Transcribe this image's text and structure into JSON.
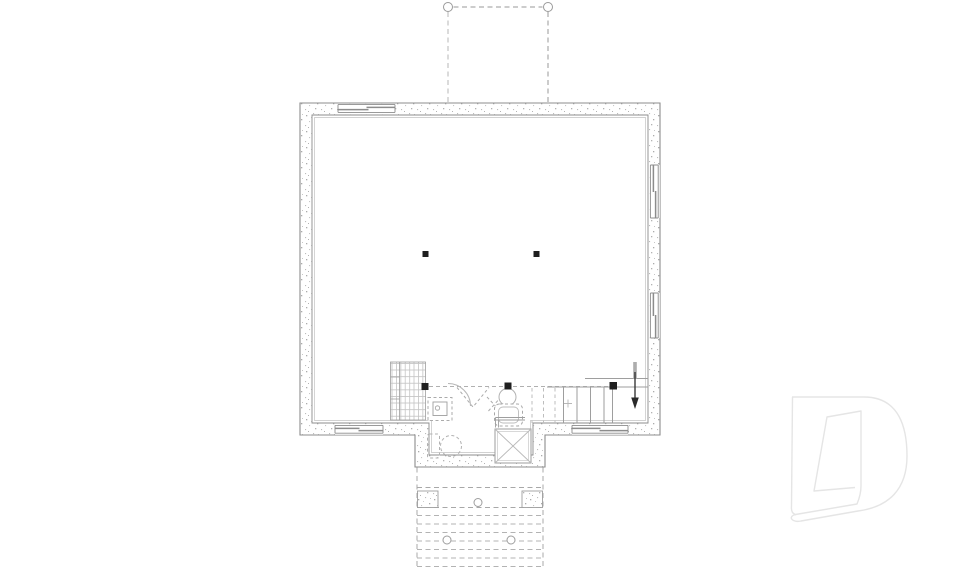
{
  "canvas": {
    "width": 960,
    "height": 569,
    "background": "#ffffff"
  },
  "plan": {
    "title": "Basement foundation floor plan drawing",
    "type": "floor-plan",
    "colors": {
      "wall_line": "#8c8c8c",
      "medium_line": "#9e9e9e",
      "light_line": "#b4b4b4",
      "dashed_line": "#a8a8a8",
      "post_black": "#1f1f1f",
      "watermark": "#e5e5e5",
      "background": "#ffffff"
    },
    "components": [
      "foundation-walls",
      "basement-windows",
      "deck-above-dashed",
      "structural-posts",
      "beam-line",
      "storage-shelving",
      "future-bathroom-fixtures",
      "water-heater",
      "landing-with-x",
      "staircase-up",
      "rear-landing-piers",
      "exterior-steps-dashed",
      "brand-watermark"
    ],
    "elements": [
      {
        "name": "foundation-wall-band",
        "type": "path",
        "attrs": {
          "d": "M300,103 H660 V435 H545 V467 H415 V435 H300 Z M312,115 H648 V423 H533 V455 H429 V423 H312 Z",
          "fill": "url(#stipple)",
          "fill-rule": "evenodd",
          "stroke": "none"
        }
      },
      {
        "name": "foundation-wall-outer-line",
        "type": "path",
        "attrs": {
          "d": "M300,103 H660 V435 H545 V467 H415 V435 H300 Z",
          "fill": "none",
          "stroke": "#8c8c8c",
          "stroke-width": "1.1"
        }
      },
      {
        "name": "foundation-wall-inner-line",
        "type": "path",
        "attrs": {
          "d": "M312,115 H648 V423 H533 V455 H429 V423 H312 Z",
          "fill": "none",
          "stroke": "#8c8c8c",
          "stroke-width": "0.9"
        }
      },
      {
        "name": "foundation-wall-furring-line",
        "type": "path",
        "attrs": {
          "d": "M314.5,117.5 H645.5 V420.5 H530.5 V452.5 H431.5 V420.5 H314.5 Z",
          "fill": "none",
          "stroke": "#c2c2c2",
          "stroke-width": "0.7"
        }
      },
      {
        "name": "window-top-opening",
        "type": "rect",
        "attrs": {
          "x": "338",
          "y": "103.6",
          "width": "57",
          "height": "10.8",
          "fill": "#ffffff"
        }
      },
      {
        "name": "window-top-frame",
        "type": "path",
        "attrs": {
          "d": "M338,104.6 H395 M338,112.4 H395 M338,104.6 V112.4 M395,104.6 V112.4",
          "fill": "none",
          "stroke": "#8c8c8c",
          "stroke-width": "0.9"
        }
      },
      {
        "name": "window-top-sash",
        "type": "path",
        "attrs": {
          "d": "M338,109.6 H368.5 M366.5,107.4 H395",
          "fill": "none",
          "stroke": "#8c8c8c",
          "stroke-width": "1.5"
        }
      },
      {
        "name": "window-bottom-left-opening",
        "type": "rect",
        "attrs": {
          "x": "335",
          "y": "424.2",
          "width": "48",
          "height": "10.6",
          "fill": "#ffffff"
        }
      },
      {
        "name": "window-bottom-left-frame",
        "type": "path",
        "attrs": {
          "d": "M335,425.4 H383 M335,433.2 H383 M335,425.4 V433.2 M383,425.4 V433.2",
          "fill": "none",
          "stroke": "#8c8c8c",
          "stroke-width": "0.9"
        }
      },
      {
        "name": "window-bottom-left-sash",
        "type": "path",
        "attrs": {
          "d": "M335,428.4 H359.5 M358.5,430.6 H383",
          "fill": "none",
          "stroke": "#8c8c8c",
          "stroke-width": "1.5"
        }
      },
      {
        "name": "window-bottom-right-opening",
        "type": "rect",
        "attrs": {
          "x": "572",
          "y": "424.2",
          "width": "56",
          "height": "10.6",
          "fill": "#ffffff"
        }
      },
      {
        "name": "window-bottom-right-frame",
        "type": "path",
        "attrs": {
          "d": "M572,425.4 H628 M572,433.2 H628 M572,425.4 V433.2 M628,425.4 V433.2",
          "fill": "none",
          "stroke": "#8c8c8c",
          "stroke-width": "0.9"
        }
      },
      {
        "name": "window-bottom-right-sash",
        "type": "path",
        "attrs": {
          "d": "M572,428.4 H600.5 M599.5,430.6 H628",
          "fill": "none",
          "stroke": "#8c8c8c",
          "stroke-width": "1.5"
        }
      },
      {
        "name": "window-right-upper-opening",
        "type": "rect",
        "attrs": {
          "x": "649.2",
          "y": "165",
          "width": "10.6",
          "height": "53",
          "fill": "#ffffff"
        }
      },
      {
        "name": "window-right-upper-frame",
        "type": "path",
        "attrs": {
          "d": "M650.4,165 V218 M658.2,165 V218 M650.4,165 H658.2 M650.4,218 H658.2",
          "fill": "none",
          "stroke": "#8c8c8c",
          "stroke-width": "0.9"
        }
      },
      {
        "name": "window-right-upper-sash",
        "type": "path",
        "attrs": {
          "d": "M653.4,165 V192 M655.6,191 V218",
          "fill": "none",
          "stroke": "#8c8c8c",
          "stroke-width": "1.5"
        }
      },
      {
        "name": "window-right-lower-opening",
        "type": "rect",
        "attrs": {
          "x": "649.2",
          "y": "293",
          "width": "10.6",
          "height": "45",
          "fill": "#ffffff"
        }
      },
      {
        "name": "window-right-lower-frame",
        "type": "path",
        "attrs": {
          "d": "M650.4,293 V338 M658.2,293 V338 M650.4,293 H658.2 M650.4,338 H658.2",
          "fill": "none",
          "stroke": "#8c8c8c",
          "stroke-width": "0.9"
        }
      },
      {
        "name": "window-right-lower-sash",
        "type": "path",
        "attrs": {
          "d": "M653.4,293 V316 M655.6,315 V338",
          "fill": "none",
          "stroke": "#8c8c8c",
          "stroke-width": "1.5"
        }
      },
      {
        "name": "deck-above-post-left",
        "type": "circle",
        "attrs": {
          "cx": "448",
          "cy": "7",
          "r": "4.5",
          "fill": "#ffffff",
          "stroke": "#9a9a9a",
          "stroke-width": "1"
        }
      },
      {
        "name": "deck-above-post-right",
        "type": "circle",
        "attrs": {
          "cx": "548",
          "cy": "7",
          "r": "4.5",
          "fill": "#ffffff",
          "stroke": "#9a9a9a",
          "stroke-width": "1"
        }
      },
      {
        "name": "deck-above-edge-top",
        "type": "line",
        "attrs": {
          "x1": "453.5",
          "y1": "7",
          "x2": "542.5",
          "y2": "7",
          "stroke": "#9a9a9a",
          "stroke-width": "1",
          "stroke-dasharray": "5 3.5"
        }
      },
      {
        "name": "deck-above-edge-left",
        "type": "line",
        "attrs": {
          "x1": "448",
          "y1": "12",
          "x2": "448",
          "y2": "102",
          "stroke": "#c3c3c3",
          "stroke-width": "1.2",
          "stroke-dasharray": "5 3.5"
        }
      },
      {
        "name": "deck-above-edge-right",
        "type": "line",
        "attrs": {
          "x1": "548",
          "y1": "12",
          "x2": "548",
          "y2": "102",
          "stroke": "#9a9a9a",
          "stroke-width": "1",
          "stroke-dasharray": "5 3.5"
        }
      },
      {
        "name": "beam-dashed-line",
        "type": "line",
        "attrs": {
          "x1": "429",
          "y1": "386.5",
          "x2": "610",
          "y2": "386.5",
          "stroke": "#b0b0b0",
          "stroke-width": "1",
          "stroke-dasharray": "4 3"
        }
      },
      {
        "name": "storage-shelving-hatch",
        "type": "rect",
        "attrs": {
          "x": "390.5",
          "y": "362",
          "width": "35",
          "height": "58",
          "fill": "url(#gridhatch)",
          "stroke": "#9e9e9e",
          "stroke-width": "0.8"
        }
      },
      {
        "name": "storage-shelving-divider",
        "type": "path",
        "attrs": {
          "d": "M399.5,362 V420 M390.5,377 H399.5 M390.5,399 H399.5",
          "fill": "none",
          "stroke": "#9e9e9e",
          "stroke-width": "0.8"
        }
      },
      {
        "name": "door-swing-arc",
        "type": "path",
        "attrs": {
          "d": "M448,383.5 A22.5,22.5 0 0 1 470.5,406",
          "fill": "none",
          "stroke": "#b8b8b8",
          "stroke-width": "1"
        }
      },
      {
        "name": "door-leaf-dashed-v",
        "type": "polyline",
        "attrs": {
          "points": "457,387.5 473,407 489,387.5",
          "fill": "none",
          "stroke": "#ababab",
          "stroke-width": "1",
          "stroke-dasharray": "3 2.5"
        }
      },
      {
        "name": "door-leaf-dashed-a",
        "type": "line",
        "attrs": {
          "x1": "487",
          "y1": "397",
          "x2": "501",
          "y2": "412",
          "stroke": "#ababab",
          "stroke-width": "1",
          "stroke-dasharray": "3 2.5"
        }
      },
      {
        "name": "door-leaf-dashed-b",
        "type": "line",
        "attrs": {
          "x1": "501.5",
          "y1": "396.5",
          "x2": "488",
          "y2": "411.5",
          "stroke": "#ababab",
          "stroke-width": "1",
          "stroke-dasharray": "3 2.5"
        }
      },
      {
        "name": "laundry-cabinet-outline",
        "type": "rect",
        "attrs": {
          "x": "428",
          "y": "397.5",
          "width": "24",
          "height": "23",
          "fill": "#ffffff",
          "stroke": "#ababab",
          "stroke-width": "1",
          "stroke-dasharray": "3 2.5"
        }
      },
      {
        "name": "laundry-sink-inner",
        "type": "rect",
        "attrs": {
          "x": "433",
          "y": "402",
          "width": "14",
          "height": "13.5",
          "fill": "none",
          "stroke": "#9e9e9e",
          "stroke-width": "0.9"
        }
      },
      {
        "name": "laundry-drain",
        "type": "circle",
        "attrs": {
          "cx": "437.5",
          "cy": "408",
          "r": "2.2",
          "fill": "none",
          "stroke": "#9e9e9e",
          "stroke-width": "0.8"
        }
      },
      {
        "name": "toilet-bowl",
        "type": "circle",
        "attrs": {
          "cx": "507.5",
          "cy": "397",
          "r": "8.5",
          "fill": "#ffffff",
          "stroke": "#b2b2b2",
          "stroke-width": "1"
        }
      },
      {
        "name": "toilet-tank",
        "type": "rect",
        "attrs": {
          "x": "494.5",
          "y": "404",
          "width": "28",
          "height": "22",
          "rx": "5",
          "fill": "#ffffff",
          "stroke": "#a8a8a8",
          "stroke-width": "1",
          "stroke-dasharray": "3 2.5"
        }
      },
      {
        "name": "toilet-tank-inner",
        "type": "rect",
        "attrs": {
          "x": "498.5",
          "y": "407",
          "width": "20",
          "height": "16",
          "rx": "4.5",
          "fill": "none",
          "stroke": "#bcbcbc",
          "stroke-width": "0.9"
        }
      },
      {
        "name": "partition-stub-wall",
        "type": "path",
        "attrs": {
          "d": "M495.5,417.5 H525 M495.5,420 H525 M495.5,417.5 V427.5 M498.5,420 V427.5",
          "fill": "none",
          "stroke": "#9e9e9e",
          "stroke-width": "0.9"
        }
      },
      {
        "name": "landing-box",
        "type": "rect",
        "attrs": {
          "x": "495",
          "y": "429",
          "width": "36",
          "height": "34",
          "fill": "#ffffff",
          "stroke": "#9e9e9e",
          "stroke-width": "1"
        }
      },
      {
        "name": "landing-box-inner",
        "type": "rect",
        "attrs": {
          "x": "497.5",
          "y": "431.5",
          "width": "31",
          "height": "29",
          "fill": "none",
          "stroke": "#cfcfcf",
          "stroke-width": "0.8"
        }
      },
      {
        "name": "landing-box-diagonal-1",
        "type": "line",
        "attrs": {
          "x1": "495",
          "y1": "429",
          "x2": "531",
          "y2": "463",
          "stroke": "#b8b8b8",
          "stroke-width": "0.9"
        }
      },
      {
        "name": "landing-box-diagonal-2",
        "type": "line",
        "attrs": {
          "x1": "531",
          "y1": "429",
          "x2": "495",
          "y2": "463",
          "stroke": "#b8b8b8",
          "stroke-width": "0.9"
        }
      },
      {
        "name": "water-heater-circle",
        "type": "circle",
        "attrs": {
          "cx": "451",
          "cy": "446",
          "r": "10.5",
          "fill": "none",
          "stroke": "#b2b2b2",
          "stroke-width": "1",
          "stroke-dasharray": "3 2.5"
        }
      },
      {
        "name": "equipment-rect",
        "type": "rect",
        "attrs": {
          "x": "427.5",
          "y": "434",
          "width": "12",
          "height": "24",
          "rx": "2",
          "fill": "none",
          "stroke": "#b2b2b2",
          "stroke-width": "1",
          "stroke-dasharray": "3 2.5"
        }
      },
      {
        "name": "stair-treads-dashed",
        "type": "path",
        "attrs": {
          "d": "M532,388 V423 M543.5,388 V423 M555,388 V423",
          "fill": "none",
          "stroke": "#bdbdbd",
          "stroke-width": "1",
          "stroke-dasharray": "3.5 3"
        }
      },
      {
        "name": "stair-treads",
        "type": "path",
        "attrs": {
          "d": "M563.5,387.5 V423 M577,387.5 V423 M590.5,387.5 V423 M604,387.5 V423",
          "fill": "none",
          "stroke": "#9e9e9e",
          "stroke-width": "1"
        }
      },
      {
        "name": "stair-right-stringer",
        "type": "line",
        "attrs": {
          "x1": "612.5",
          "y1": "387.5",
          "x2": "612.5",
          "y2": "423",
          "stroke": "#9e9e9e",
          "stroke-width": "1"
        }
      },
      {
        "name": "stair-guard-line-upper",
        "type": "line",
        "attrs": {
          "x1": "585",
          "y1": "378.5",
          "x2": "648",
          "y2": "378.5",
          "stroke": "#9e9e9e",
          "stroke-width": "1"
        }
      },
      {
        "name": "stair-guard-line-lower",
        "type": "line",
        "attrs": {
          "x1": "547",
          "y1": "387",
          "x2": "648",
          "y2": "387",
          "stroke": "#9e9e9e",
          "stroke-width": "1"
        }
      },
      {
        "name": "stair-arrow-tail",
        "type": "rect",
        "attrs": {
          "x": "633.2",
          "y": "362",
          "width": "3.6",
          "height": "17",
          "fill": "#adadad"
        }
      },
      {
        "name": "stair-arrow-line",
        "type": "line",
        "attrs": {
          "x1": "635",
          "y1": "372",
          "x2": "635",
          "y2": "399",
          "stroke": "#2a2a2a",
          "stroke-width": "1.3"
        }
      },
      {
        "name": "stair-arrow-head",
        "type": "polygon",
        "attrs": {
          "points": "631.2,397.5 638.8,397.5 635,409",
          "fill": "#2a2a2a"
        }
      },
      {
        "name": "floor-drain-cross",
        "type": "path",
        "attrs": {
          "d": "M564,403.5 H572 M568,399.5 V407.5",
          "fill": "none",
          "stroke": "#b8b8b8",
          "stroke-width": "0.9"
        }
      },
      {
        "name": "structural-post-center-left",
        "type": "rect",
        "attrs": {
          "x": "422.5",
          "y": "251",
          "width": "6",
          "height": "6",
          "fill": "#1f1f1f"
        }
      },
      {
        "name": "structural-post-center-right",
        "type": "rect",
        "attrs": {
          "x": "533.5",
          "y": "251",
          "width": "6",
          "height": "6",
          "fill": "#1f1f1f"
        }
      },
      {
        "name": "structural-post-lower-left",
        "type": "rect",
        "attrs": {
          "x": "421.5",
          "y": "383",
          "width": "7",
          "height": "7",
          "fill": "#1f1f1f"
        }
      },
      {
        "name": "structural-post-lower-mid",
        "type": "rect",
        "attrs": {
          "x": "504.5",
          "y": "382.5",
          "width": "7",
          "height": "7",
          "fill": "#1f1f1f"
        }
      },
      {
        "name": "structural-post-stair",
        "type": "rect",
        "attrs": {
          "x": "609.5",
          "y": "382",
          "width": "7.5",
          "height": "7.5",
          "fill": "#1f1f1f"
        }
      },
      {
        "name": "rear-deck-edge-left",
        "type": "line",
        "attrs": {
          "x1": "417",
          "y1": "467.5",
          "x2": "417",
          "y2": "569",
          "stroke": "#a8a8a8",
          "stroke-width": "1",
          "stroke-dasharray": "5 3.5"
        }
      },
      {
        "name": "rear-deck-edge-right",
        "type": "line",
        "attrs": {
          "x1": "543",
          "y1": "467.5",
          "x2": "543",
          "y2": "569",
          "stroke": "#a8a8a8",
          "stroke-width": "1",
          "stroke-dasharray": "5 3.5"
        }
      },
      {
        "name": "rear-deck-lines",
        "type": "path",
        "attrs": {
          "d": "M417,487.5 H543 M417,507.5 H543",
          "fill": "none",
          "stroke": "#a8a8a8",
          "stroke-width": "1",
          "stroke-dasharray": "5 3.5"
        }
      },
      {
        "name": "rear-steps-dashed",
        "type": "path",
        "attrs": {
          "d": "M417,515.5 H543 M417,524 H543 M417,532.5 H543 M417,541 H543 M417,549.5 H543 M417,558 H543 M417,566.5 H543",
          "fill": "none",
          "stroke": "#b3b3b3",
          "stroke-width": "1",
          "stroke-dasharray": "5 3.5"
        }
      },
      {
        "name": "rear-pier-left",
        "type": "rect",
        "attrs": {
          "x": "417.5",
          "y": "491",
          "width": "20.5",
          "height": "16.5",
          "fill": "url(#stipple)",
          "stroke": "#9e9e9e",
          "stroke-width": "0.9"
        }
      },
      {
        "name": "rear-pier-right",
        "type": "rect",
        "attrs": {
          "x": "522",
          "y": "491",
          "width": "20.5",
          "height": "16.5",
          "fill": "url(#stipple)",
          "stroke": "#9e9e9e",
          "stroke-width": "0.9"
        }
      },
      {
        "name": "rear-post-center",
        "type": "circle",
        "attrs": {
          "cx": "478",
          "cy": "502.5",
          "r": "4",
          "fill": "#ffffff",
          "stroke": "#9e9e9e",
          "stroke-width": "1"
        }
      },
      {
        "name": "rear-step-post-left",
        "type": "circle",
        "attrs": {
          "cx": "447",
          "cy": "540",
          "r": "4",
          "fill": "#ffffff",
          "stroke": "#9e9e9e",
          "stroke-width": "1"
        }
      },
      {
        "name": "rear-step-post-right",
        "type": "circle",
        "attrs": {
          "cx": "511",
          "cy": "540",
          "r": "4",
          "fill": "#ffffff",
          "stroke": "#9e9e9e",
          "stroke-width": "1"
        }
      },
      {
        "name": "brand-watermark-d-logo",
        "type": "path",
        "attrs": {
          "d": "M792,397 L864,397 C900,397 907,429 907,456 C907,489 889,507 858,511 L801,521 C792,523 787.5,516.5 795.5,514.5 L857,504 C859.5,498 861,492.5 861,486 L861,411 L827,417 L814,491 L855,487.5 M792.5,397 L791.5,506 C791,511.5 792.5,513.5 796,514.8",
          "fill": "none",
          "stroke": "#e5e5e5",
          "stroke-width": "1.4",
          "stroke-linejoin": "round"
        }
      }
    ]
  }
}
